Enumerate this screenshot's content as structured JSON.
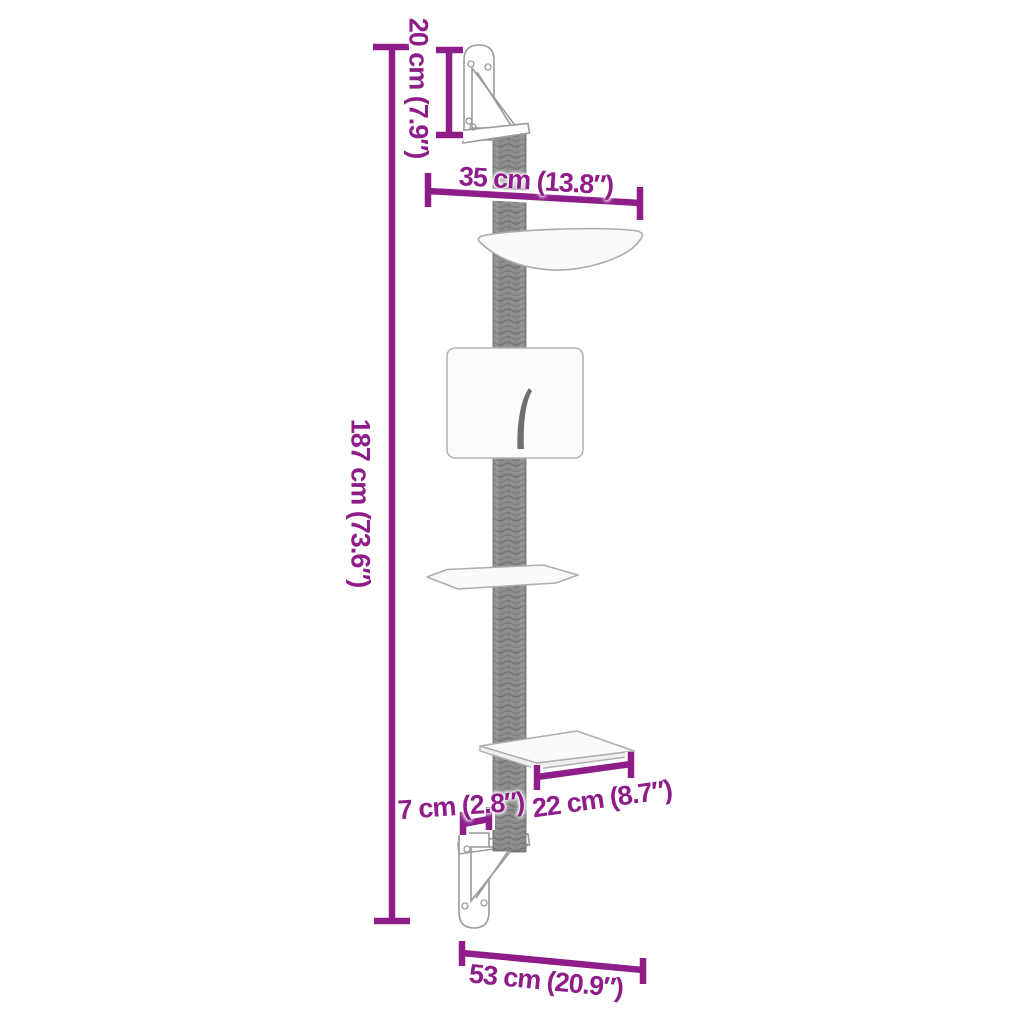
{
  "page": {
    "background": "#ffffff",
    "accent_color": "#8e1d8a",
    "post_color": "#8f8f8f",
    "outline_color": "#a6a6a6"
  },
  "product": {
    "name": "wall-mounted cat tree with scratching post",
    "parts": [
      "top wall bracket",
      "sisal scratching post",
      "hammock bowl",
      "cat house with entry slit",
      "upper platform",
      "lower platform",
      "bottom wall bracket"
    ]
  },
  "dimensions": {
    "total_height": {
      "label": "187 cm (73.6″)",
      "cm": 187,
      "inch": 73.6,
      "orientation": "vertical"
    },
    "bracket_height": {
      "label": "20 cm (7.9″)",
      "cm": 20,
      "inch": 7.9,
      "orientation": "vertical"
    },
    "bowl_width": {
      "label": "35 cm (13.8″)",
      "cm": 35,
      "inch": 13.8,
      "orientation": "horizontal"
    },
    "platform_depth": {
      "label": "22 cm (8.7″)",
      "cm": 22,
      "inch": 8.7,
      "orientation": "horizontal"
    },
    "post_offset": {
      "label": "7 cm (2.8″)",
      "cm": 7,
      "inch": 2.8,
      "orientation": "horizontal"
    },
    "base_width": {
      "label": "53 cm (20.9″)",
      "cm": 53,
      "inch": 20.9,
      "orientation": "horizontal"
    }
  }
}
